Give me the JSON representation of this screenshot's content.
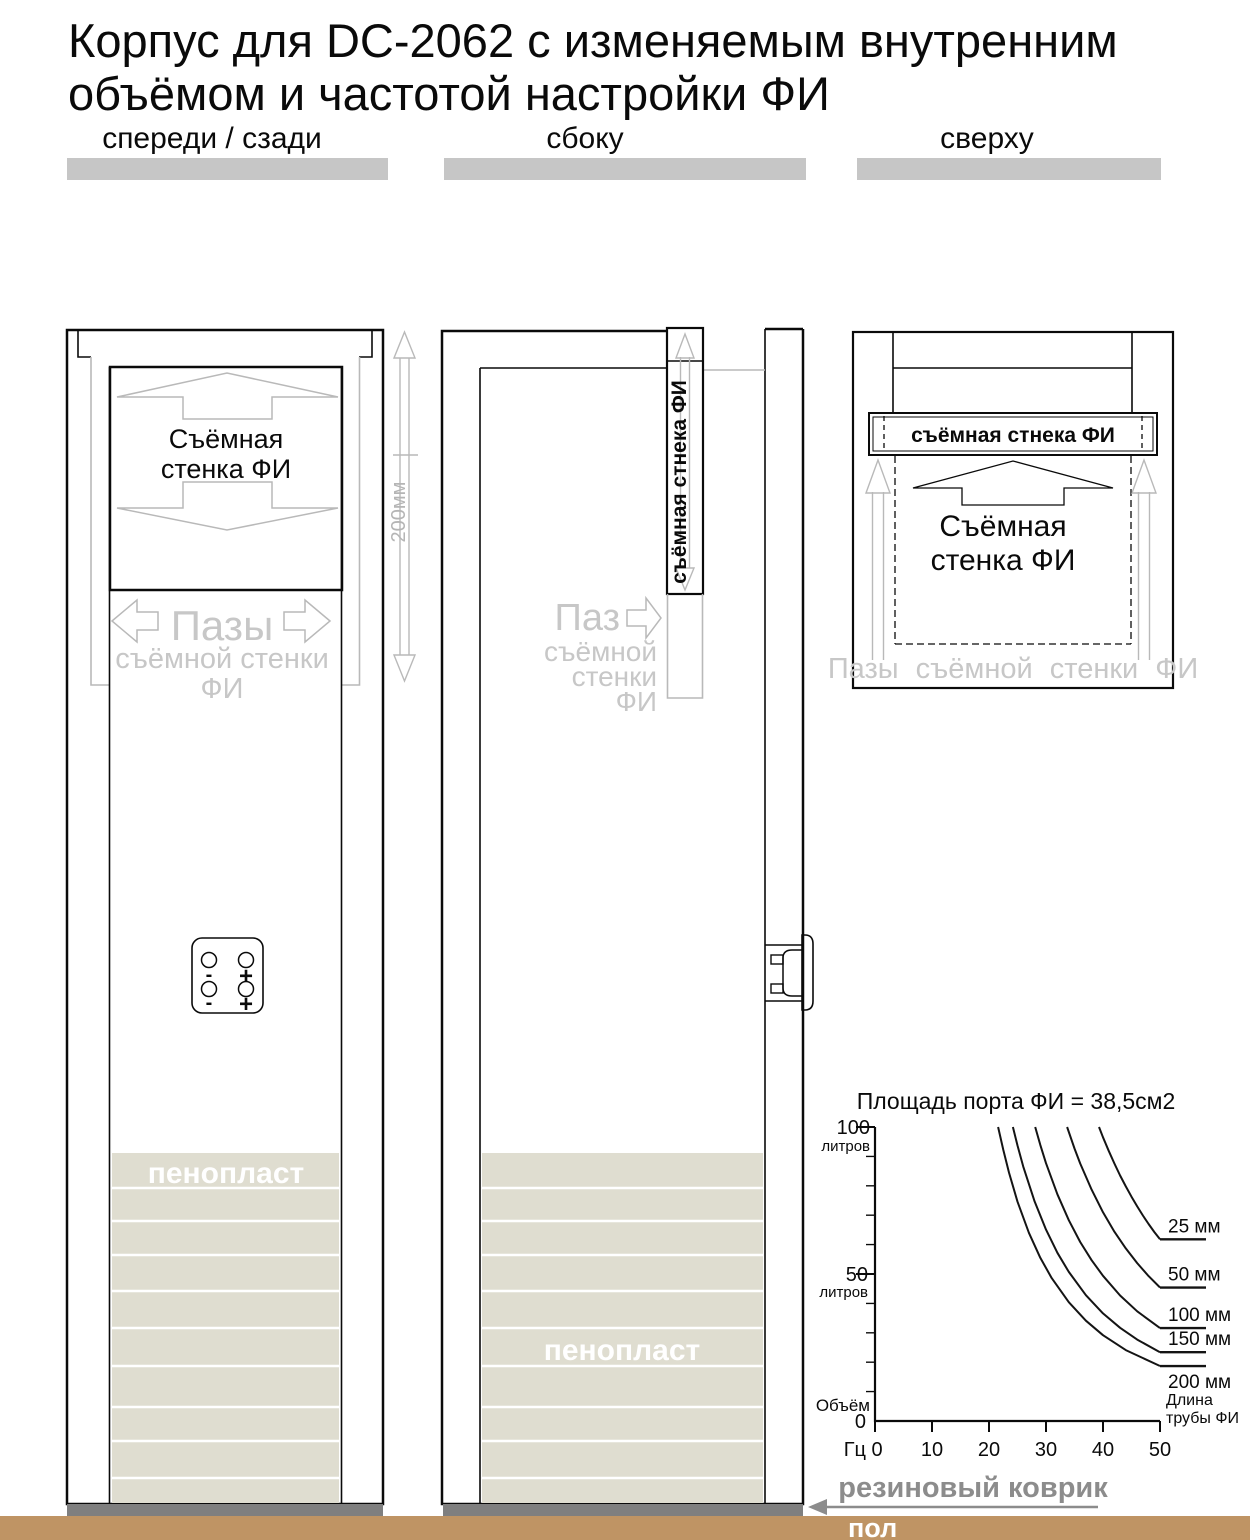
{
  "page": {
    "title_line1": "Корпус для DC-2062 с изменяемым внутренним",
    "title_line2": "объёмом и частотой настройки ФИ"
  },
  "views": {
    "front": {
      "label": "спереди / сзади",
      "removable_wall_line1": "Съёмная",
      "removable_wall_line2": "стенка ФИ",
      "grooves_line1": "Пазы",
      "grooves_line2": "съёмной стенки",
      "grooves_line3": "ФИ",
      "dimension_label": "200мм",
      "foam_label": "пенопласт",
      "terminal_labels": [
        "-",
        "+",
        "-",
        "+"
      ]
    },
    "side": {
      "label": "сбоку",
      "removable_wall_label": "съёмная стнека ФИ",
      "groove_line1": "Паз",
      "groove_line2": "съёмной",
      "groove_line3": "стенки",
      "groove_line4": "ФИ",
      "foam_label": "пенопласт"
    },
    "top": {
      "label": "сверху",
      "bar_label": "съёмная стнека ФИ",
      "removable_wall_line1": "Съёмная",
      "removable_wall_line2": "стенка ФИ",
      "grooves_label": "Пазы съёмной стенки ФИ"
    }
  },
  "chart_data": {
    "type": "line",
    "title": "Площадь порта ФИ = 38,5см2",
    "xlabel": "Гц",
    "ylabel": "Объём, литров",
    "xlim": [
      0,
      50
    ],
    "ylim": [
      0,
      100
    ],
    "grid": false,
    "x_axis": {
      "unit_label": "Гц",
      "tick_labels": [
        "0",
        "10",
        "20",
        "30",
        "40",
        "50"
      ]
    },
    "y_axis": {
      "top_value": "100",
      "top_unit": "литров",
      "mid_value": "50",
      "mid_unit": "литров",
      "origin_label": "Объём",
      "origin_value": "0",
      "minor_tick_step": 10
    },
    "series_label_title_line1": "Длина",
    "series_label_title_line2": "трубы ФИ",
    "series": [
      {
        "name": "25 мм",
        "points": [
          [
            39.3,
            100
          ],
          [
            40,
            96.5
          ],
          [
            41,
            91.9
          ],
          [
            42,
            87.6
          ],
          [
            43,
            83.5
          ],
          [
            44,
            79.8
          ],
          [
            45,
            76.3
          ],
          [
            46,
            73.0
          ],
          [
            47,
            69.9
          ],
          [
            48,
            67.0
          ],
          [
            49,
            64.3
          ],
          [
            50,
            61.8
          ]
        ]
      },
      {
        "name": "50 мм",
        "points": [
          [
            33.7,
            100
          ],
          [
            35,
            92.7
          ],
          [
            36,
            87.6
          ],
          [
            38,
            78.7
          ],
          [
            40,
            71.0
          ],
          [
            42,
            64.4
          ],
          [
            44,
            58.7
          ],
          [
            46,
            53.7
          ],
          [
            48,
            49.3
          ],
          [
            50,
            45.4
          ]
        ]
      },
      {
        "name": "100 мм",
        "points": [
          [
            28.1,
            100
          ],
          [
            29,
            93.9
          ],
          [
            30,
            87.7
          ],
          [
            32,
            77.1
          ],
          [
            34,
            68.3
          ],
          [
            36,
            60.9
          ],
          [
            38,
            54.7
          ],
          [
            40,
            49.4
          ],
          [
            43,
            42.7
          ],
          [
            46,
            37.3
          ],
          [
            50,
            31.6
          ]
        ]
      },
      {
        "name": "150 мм",
        "points": [
          [
            24.2,
            100
          ],
          [
            25,
            93.7
          ],
          [
            26,
            86.6
          ],
          [
            28,
            74.7
          ],
          [
            30,
            65.1
          ],
          [
            32,
            57.2
          ],
          [
            34,
            50.7
          ],
          [
            37,
            42.8
          ],
          [
            40,
            36.6
          ],
          [
            43,
            31.7
          ],
          [
            46,
            27.7
          ],
          [
            50,
            23.4
          ]
        ]
      },
      {
        "name": "200 мм",
        "points": [
          [
            21.6,
            100
          ],
          [
            22.5,
            92.2
          ],
          [
            23.5,
            84.5
          ],
          [
            25,
            74.6
          ],
          [
            27,
            64.0
          ],
          [
            29,
            55.5
          ],
          [
            31,
            48.6
          ],
          [
            34,
            40.4
          ],
          [
            37,
            34.1
          ],
          [
            40,
            29.2
          ],
          [
            44,
            24.1
          ],
          [
            50,
            18.7
          ]
        ],
        "label_below": true
      }
    ]
  },
  "footer": {
    "rubber_mat_label": "резиновый коврик",
    "floor_label": "пол"
  },
  "colors": {
    "floor": "#bf9464",
    "rubber_mat": "#7f7f7f",
    "foam": "#dfddd0",
    "header_bar": "#c6c6c6",
    "ghost_line": "#b9b9b9",
    "ghost_text": "#c7c7c7",
    "gray_text": "#8c8c8c"
  }
}
